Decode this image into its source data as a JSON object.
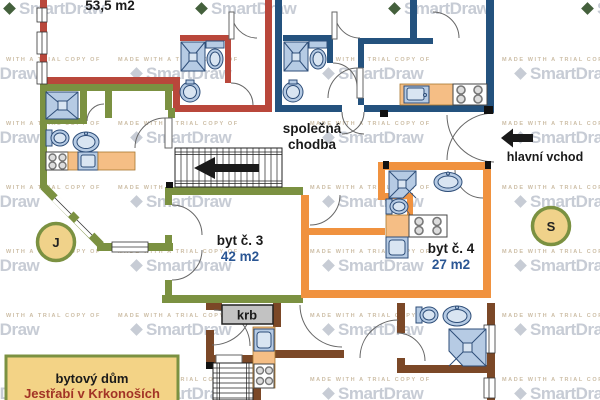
{
  "watermark": {
    "logo_text": "SmartDraw",
    "trial_text": "MADE WITH A TRIAL COPY OF",
    "trial_text_short": "WITH A TRIAL COPY OF"
  },
  "plan": {
    "apartment_top_left": {
      "area_label": "53,5 m2",
      "wall_color": "#b9473b"
    },
    "apartment_top_right": {
      "wall_color": "#24527e"
    },
    "apartment_3": {
      "name": "byt č. 3",
      "area": "42 m2",
      "wall_color": "#7b9141"
    },
    "apartment_4": {
      "name": "byt č. 4",
      "area": "27 m2",
      "wall_color": "#f0923f"
    },
    "apartment_bottom": {
      "wall_color": "#7b4827"
    },
    "corridor": {
      "label_line1": "společná",
      "label_line2": "chodba"
    },
    "entrance": {
      "label": "hlavní vchod"
    },
    "fireplace": {
      "label": "krb"
    },
    "marker_left": {
      "label": "J"
    },
    "marker_right": {
      "label": "S"
    },
    "title_box": {
      "line1": "bytový dům",
      "line2": "Jestřabí v Krkonoších"
    }
  },
  "colors": {
    "fixture_fill": "#b6cbe4",
    "fixture_stroke": "#2e4e79",
    "counter_fill": "#f5be85",
    "area_value_text": "#2a5694",
    "title_line2_text": "#a23326",
    "marker_fill": "#f0d28a",
    "marker_border": "#7b9141",
    "fireplace_fill": "#c2c2c2",
    "watermark_gray": "#c7ccd5",
    "watermark_diamond_dark": "#44603c"
  }
}
